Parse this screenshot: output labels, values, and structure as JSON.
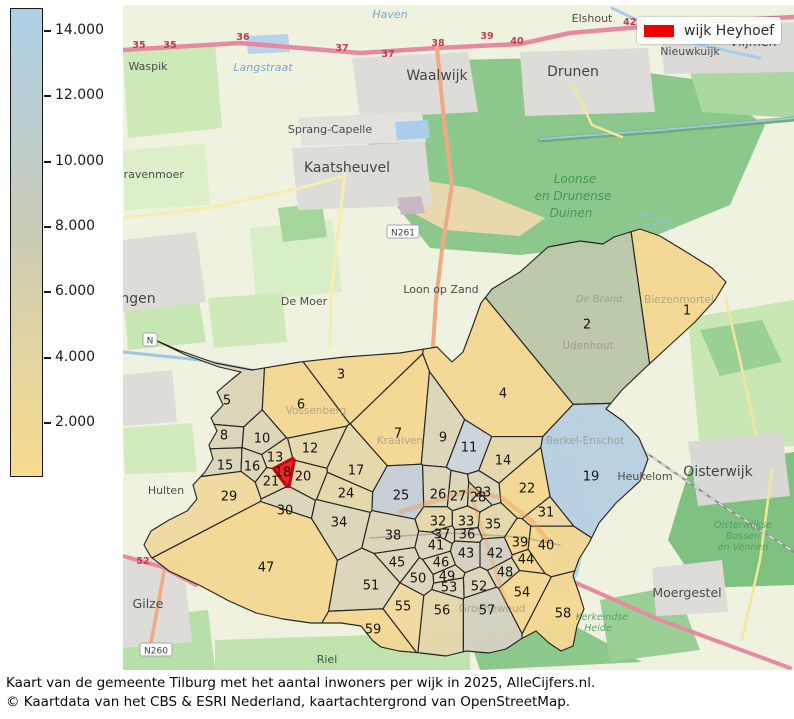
{
  "colorbar": {
    "ticks": [
      "14.000",
      "12.000",
      "10.000",
      "8.000",
      "6.000",
      "4.000",
      "2.000"
    ],
    "gradient": [
      "#aed0e6",
      "#bccdd0",
      "#ccccb4",
      "#e4d5a0",
      "#f8db8d"
    ]
  },
  "legend": {
    "label": "wijk Heyhoef",
    "color": "#ee0000"
  },
  "caption": {
    "line1": "Kaart van de gemeente Tilburg met het aantal inwoners per wijk in 2025, AlleCijfers.nl.",
    "line2": "© Kaartdata van het CBS & ESRI Nederland, kaartachtergrond van OpenStreetMap."
  },
  "map": {
    "highlighted_district": 18,
    "highlight_fill": "#e8211d",
    "highlight_stroke": "#c00513",
    "boundary": [
      [
        146,
        336
      ],
      [
        178,
        350
      ],
      [
        215,
        363
      ],
      [
        252,
        370
      ],
      [
        300,
        362
      ],
      [
        345,
        357
      ],
      [
        400,
        353
      ],
      [
        437,
        347
      ],
      [
        452,
        362
      ],
      [
        463,
        352
      ],
      [
        472,
        328
      ],
      [
        481,
        303
      ],
      [
        492,
        289
      ],
      [
        520,
        272
      ],
      [
        548,
        247
      ],
      [
        580,
        241
      ],
      [
        603,
        244
      ],
      [
        614,
        237
      ],
      [
        640,
        229
      ],
      [
        660,
        236
      ],
      [
        688,
        253
      ],
      [
        712,
        268
      ],
      [
        726,
        282
      ],
      [
        715,
        300
      ],
      [
        695,
        322
      ],
      [
        670,
        345
      ],
      [
        645,
        368
      ],
      [
        622,
        390
      ],
      [
        606,
        409
      ],
      [
        623,
        421
      ],
      [
        639,
        438
      ],
      [
        648,
        459
      ],
      [
        640,
        481
      ],
      [
        616,
        503
      ],
      [
        599,
        523
      ],
      [
        589,
        543
      ],
      [
        579,
        559
      ],
      [
        573,
        576
      ],
      [
        579,
        593
      ],
      [
        584,
        609
      ],
      [
        577,
        626
      ],
      [
        573,
        646
      ],
      [
        561,
        651
      ],
      [
        549,
        643
      ],
      [
        536,
        631
      ],
      [
        521,
        639
      ],
      [
        506,
        649
      ],
      [
        489,
        653
      ],
      [
        466,
        651
      ],
      [
        446,
        656
      ],
      [
        421,
        653
      ],
      [
        399,
        651
      ],
      [
        381,
        647
      ],
      [
        373,
        641
      ],
      [
        361,
        626
      ],
      [
        341,
        623
      ],
      [
        311,
        623
      ],
      [
        283,
        619
      ],
      [
        256,
        613
      ],
      [
        229,
        601
      ],
      [
        201,
        586
      ],
      [
        169,
        571
      ],
      [
        151,
        557
      ],
      [
        144,
        545
      ],
      [
        151,
        531
      ],
      [
        169,
        520
      ],
      [
        187,
        511
      ],
      [
        197,
        499
      ],
      [
        193,
        485
      ],
      [
        205,
        472
      ],
      [
        213,
        459
      ],
      [
        209,
        445
      ],
      [
        217,
        431
      ],
      [
        211,
        418
      ],
      [
        223,
        405
      ],
      [
        217,
        392
      ],
      [
        231,
        380
      ],
      [
        241,
        372
      ],
      [
        219,
        367
      ],
      [
        186,
        355
      ],
      [
        159,
        342
      ]
    ],
    "districts": [
      [
        1,
        687,
        310,
        2000,
        "#f3d893"
      ],
      [
        2,
        587,
        324,
        3200,
        "#bac7a9"
      ],
      [
        3,
        341,
        374,
        700,
        "#f3d893"
      ],
      [
        4,
        503,
        393,
        1600,
        "#f3d893"
      ],
      [
        5,
        227,
        400,
        700,
        "#dbd5b9"
      ],
      [
        6,
        301,
        404,
        900,
        "#f3d893"
      ],
      [
        7,
        398,
        433,
        500,
        "#f3d893"
      ],
      [
        8,
        224,
        435,
        150,
        "#dbd5b9"
      ],
      [
        9,
        443,
        437,
        200,
        "#dbd5b9"
      ],
      [
        10,
        262,
        438,
        150,
        "#dbd5b9"
      ],
      [
        11,
        469,
        447,
        200,
        "#cad5da"
      ],
      [
        12,
        310,
        448,
        150,
        "#e5d7ab"
      ],
      [
        13,
        275,
        457,
        60,
        "#e5d7ab"
      ],
      [
        14,
        503,
        460,
        250,
        "#e5d7ab"
      ],
      [
        15,
        225,
        465,
        250,
        "#dbd5b9"
      ],
      [
        16,
        252,
        466,
        100,
        "#dbd5b9"
      ],
      [
        17,
        356,
        470,
        300,
        "#e5d7ab"
      ],
      [
        18,
        283,
        472,
        25,
        "#e8211d"
      ],
      [
        19,
        591,
        476,
        2000,
        "#b8cfe1"
      ],
      [
        20,
        303,
        476,
        80,
        "#e5d7ab"
      ],
      [
        21,
        271,
        481,
        80,
        "#e5d7ab"
      ],
      [
        22,
        527,
        488,
        500,
        "#f3d893"
      ],
      [
        23,
        483,
        492,
        30,
        "#dbd5b9"
      ],
      [
        24,
        346,
        493,
        250,
        "#e5d7ab"
      ],
      [
        25,
        401,
        495,
        350,
        "#c4ced6"
      ],
      [
        26,
        438,
        494,
        60,
        "#dbd5b9"
      ],
      [
        27,
        458,
        496,
        40,
        "#dbd5b9"
      ],
      [
        28,
        478,
        497,
        40,
        "#dbd5b9"
      ],
      [
        29,
        229,
        496,
        700,
        "#eed9a0"
      ],
      [
        30,
        285,
        510,
        350,
        "#dbd5b9"
      ],
      [
        31,
        546,
        512,
        150,
        "#eed9a0"
      ],
      [
        32,
        438,
        521,
        100,
        "#e5d7ab"
      ],
      [
        33,
        466,
        521,
        80,
        "#e5d7ab"
      ],
      [
        34,
        339,
        522,
        350,
        "#dbd5b9"
      ],
      [
        35,
        493,
        524,
        120,
        "#e5d7ab"
      ],
      [
        36,
        467,
        534,
        50,
        "#dbd5b9"
      ],
      [
        37,
        442,
        534,
        50,
        "#dbd5b9"
      ],
      [
        38,
        393,
        535,
        300,
        "#dbd5b9"
      ],
      [
        39,
        520,
        542,
        80,
        "#f3d893"
      ],
      [
        40,
        546,
        545,
        300,
        "#f3d893"
      ],
      [
        41,
        436,
        545,
        120,
        "#dbd5b9"
      ],
      [
        42,
        495,
        553,
        150,
        "#d4d1c2"
      ],
      [
        43,
        466,
        553,
        120,
        "#d4d1c2"
      ],
      [
        44,
        526,
        559,
        60,
        "#f3d893"
      ],
      [
        45,
        397,
        562,
        200,
        "#dbd5b9"
      ],
      [
        46,
        441,
        562,
        80,
        "#dbd5b9"
      ],
      [
        47,
        266,
        567,
        4000,
        "#f3d893"
      ],
      [
        48,
        505,
        572,
        100,
        "#dbd5b9"
      ],
      [
        49,
        447,
        576,
        60,
        "#dbd5b9"
      ],
      [
        50,
        418,
        578,
        100,
        "#dbd5b9"
      ],
      [
        51,
        371,
        585,
        600,
        "#dbd5b9"
      ],
      [
        52,
        479,
        586,
        100,
        "#dbd5b9"
      ],
      [
        53,
        449,
        587,
        80,
        "#dbd5b9"
      ],
      [
        54,
        522,
        592,
        350,
        "#f3d893"
      ],
      [
        55,
        403,
        606,
        300,
        "#eed9a0"
      ],
      [
        56,
        442,
        610,
        300,
        "#e5d7ab"
      ],
      [
        57,
        487,
        610,
        400,
        "#d4d1c2"
      ],
      [
        58,
        563,
        613,
        700,
        "#f3d893"
      ],
      [
        59,
        373,
        629,
        400,
        "#f3d893"
      ]
    ],
    "places": [
      [
        "Waspik",
        148,
        70,
        "town-sm"
      ],
      [
        "Waalwijk",
        437,
        80,
        "town-lg"
      ],
      [
        "Drunen",
        573,
        76,
        "town-lg"
      ],
      [
        "Elshout",
        592,
        22,
        "town-sm"
      ],
      [
        "Nieuwkuijk",
        690,
        55,
        "town-sm"
      ],
      [
        "Vlijmen",
        753,
        46,
        "town"
      ],
      [
        "Haven",
        390,
        18,
        "water-name"
      ],
      [
        "Langstraat",
        263,
        71,
        "water-name"
      ],
      [
        "Sprang-Capelle",
        330,
        133,
        "town-sm"
      ],
      [
        "Kaatsheuvel",
        347,
        172,
        "town-lg"
      ],
      [
        "Loon op Zand",
        441,
        293,
        "town-sm"
      ],
      [
        "De Moer",
        304,
        305,
        "town-sm"
      ],
      [
        "s-Gravenmoer",
        105,
        178,
        "town-sm",
        "start"
      ],
      [
        "Dongen",
        101,
        303,
        "town-lg",
        "start"
      ],
      [
        "Hulten",
        166,
        494,
        "town-sm"
      ],
      [
        "Gilze",
        148,
        608,
        "town"
      ],
      [
        "Riel",
        327,
        663,
        "town-sm"
      ],
      [
        "Heukelom",
        645,
        480,
        "town-sm"
      ],
      [
        "Oisterwijk",
        718,
        476,
        "town-lg"
      ],
      [
        "Moergestel",
        687,
        597,
        "town"
      ],
      [
        "Berkel-Enschot",
        585,
        444,
        "faint"
      ],
      [
        "Udenhout",
        588,
        349,
        "faint"
      ],
      [
        "De Brand",
        599,
        302,
        "faint-nature"
      ],
      [
        "Biezenmortel",
        679,
        303,
        "faint"
      ],
      [
        "Vossenberg",
        316,
        414,
        "faint"
      ],
      [
        "Kraaiven",
        400,
        444,
        "faint"
      ],
      [
        "Groenewoud",
        492,
        612,
        "faint"
      ],
      [
        "Loonse",
        575,
        183,
        "nature"
      ],
      [
        "en Drunense",
        573,
        200,
        "nature"
      ],
      [
        "Duinen",
        571,
        217,
        "nature"
      ],
      [
        "Oisterwijkse",
        743,
        528,
        "nature-sm"
      ],
      [
        "Bossen",
        743,
        539,
        "nature-sm"
      ],
      [
        "en Vennen",
        743,
        550,
        "nature-sm"
      ],
      [
        "Kerkeindse",
        602,
        620,
        "nature-sm"
      ],
      [
        "Heide",
        598,
        631,
        "nature-sm"
      ]
    ],
    "road_labels": [
      [
        "35",
        139,
        48
      ],
      [
        "35",
        170,
        48
      ],
      [
        "36",
        243,
        40
      ],
      [
        "37",
        342,
        51
      ],
      [
        "37",
        388,
        57
      ],
      [
        "38",
        438,
        46
      ],
      [
        "39",
        487,
        39
      ],
      [
        "40",
        517,
        44
      ],
      [
        "42a",
        633,
        25
      ],
      [
        "52",
        143,
        564
      ]
    ],
    "badges": [
      [
        "N261",
        403,
        233
      ],
      [
        "N260",
        156,
        651
      ],
      [
        "N",
        150,
        341
      ]
    ]
  }
}
